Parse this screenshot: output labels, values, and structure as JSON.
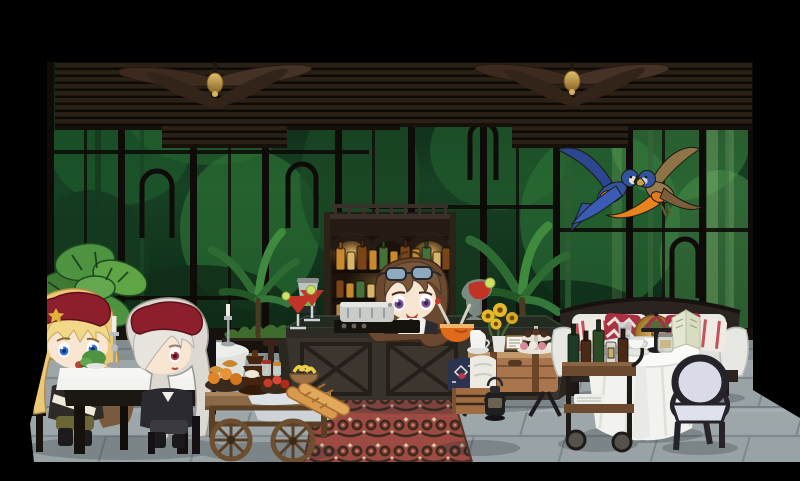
{
  "scene": {
    "description": "chibi jungle-view cafe lounge room",
    "palette": {
      "letterbox_black": "#000000",
      "jungle_dark": "#0a2012",
      "jungle_green": "#2f6b35",
      "jungle_light": "#9dc878",
      "window_frame": "#0e0b08",
      "blind_brown": "#2a2016",
      "blind_rail": "#17100a",
      "floor_grey": "#a9b3b6",
      "floor_grout": "#7f8b90",
      "wall_base": "#17110c",
      "rug_red": "#9c4a42",
      "rug_motif": "#3c2a1e",
      "rug_cream": "#d9c9a4",
      "counter_wood": "#37322b",
      "counter_top": "#232a20",
      "shelf_wood": "#241c14",
      "shelf_glow": "#c98f3a",
      "beret_red": "#8c1f2b",
      "beret_star_gold": "#e0b23a",
      "hair_blonde": "#ecc978",
      "hair_silver": "#dcd8d2",
      "hair_brown": "#6a4930",
      "eye_blue": "#2f6fd0",
      "eye_red": "#a53642",
      "eye_purple": "#7b4f93",
      "skin": "#f8e6d2",
      "sofa_cushion": "#e7e8e4",
      "sofa_frame": "#2b2320",
      "pillow_red": "#a83242",
      "pillow_gold": "#c8973f",
      "pillow_stripe_red": "#c4525a",
      "cloth_white": "#f2f2ef",
      "parrot_blue": "#33539e",
      "parrot_tan": "#9a7c4e",
      "parrot_orange": "#e8821f",
      "drink_red": "#c13227",
      "drink_orange": "#e06a1a",
      "lime_green": "#cde06b",
      "cart_wood": "#8a6a46",
      "trunk_wood": "#a9754c",
      "crate_wood": "#a06c42",
      "lantern_black": "#1f1f22",
      "bottle_amber": "#c8882e",
      "bottle_brown": "#7a4418",
      "bottle_green": "#47703a",
      "bottle_cream": "#d8b46a",
      "brass": "#c8a04a",
      "chair_dark": "#26242a",
      "chair_seat_lavender": "#d9dce8",
      "leaf_green": "#4e9340",
      "palm_green": "#2e6b33",
      "silver_metal": "#b9bcc0",
      "machine_silver": "#c9ccc9",
      "sunflower_yellow": "#e8b828"
    },
    "characters": [
      {
        "id": "blonde-beret-girl",
        "hat": "red beret with gold star",
        "hair": "long blonde",
        "eyes": "blue",
        "pose": "seated at table sipping a green bottle"
      },
      {
        "id": "silver-hair-girl",
        "hat": "red beret",
        "hair": "long silver covering one eye",
        "eyes": "red",
        "pose": "seated at table"
      },
      {
        "id": "bartender-girl",
        "hair": "brown bob with aviator sunglasses on head",
        "eyes": "purple",
        "pose": "standing behind bar counter"
      }
    ],
    "animals": [
      {
        "id": "macaw-pair",
        "desc": "blue macaw and tan macaw flying beak-to-beak"
      }
    ],
    "objects": [
      "venetian blinds",
      "ceiling fans",
      "window wall with jungle view",
      "monstera potted plant",
      "palm plants",
      "window planter boxes",
      "dining table with white cloth and candelabra",
      "round side table with candelabra",
      "wooden chair",
      "food cart with bread, fruit and chocolate fountain",
      "baguettes",
      "patterned red rug",
      "bar counter with cross-braced panels",
      "back bar shelf with lit bottles",
      "espresso machine",
      "blender",
      "red cocktails",
      "orange punch bowl",
      "trunk coffee table with sunflowers, tea set and dessert stand",
      "crate with cushions",
      "camping lantern",
      "loveseat sofa with pillows",
      "round tea table with tiffany lamp and menu",
      "bar cart with wine bottles",
      "oval-back chair",
      "stone tile floor"
    ]
  }
}
